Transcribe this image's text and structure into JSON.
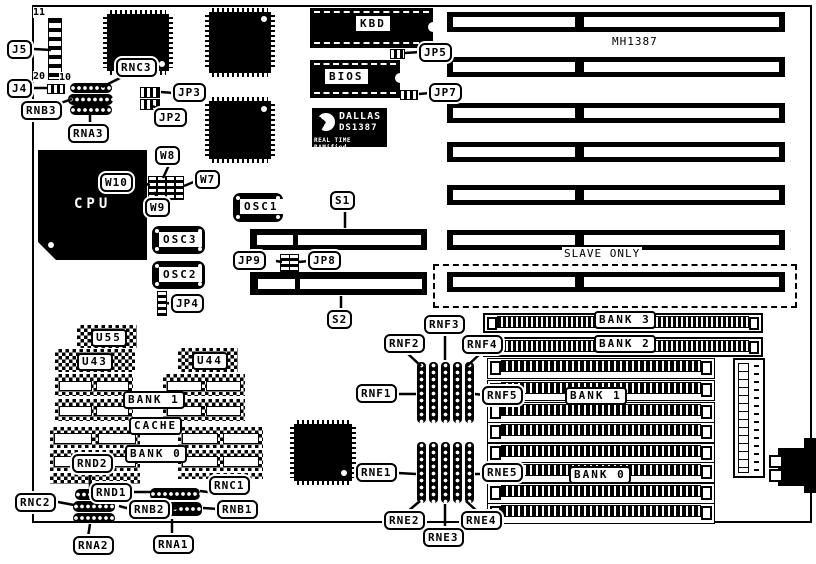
{
  "board": {
    "model": "MH1387",
    "slave_only": "SLAVE ONLY"
  },
  "pins": {
    "eleven": "11",
    "twenty": "20",
    "ten": "10"
  },
  "chips": {
    "kbd": "KBD",
    "bios": "BIOS",
    "cpu": "CPU",
    "osc1": "OSC1",
    "osc2": "OSC2",
    "osc3": "OSC3",
    "u55": "U55",
    "u43": "U43",
    "u44": "U44"
  },
  "dallas": {
    "line1": "DALLAS",
    "line2": "DS1387",
    "line3": "REAL TIME RAMified"
  },
  "cache_group": {
    "bank1": "BANK 1",
    "cache": "CACHE",
    "bank0": "BANK 0"
  },
  "memory": {
    "bank3": "BANK 3",
    "bank2": "BANK 2",
    "bank1": "BANK 1",
    "bank0": "BANK 0"
  },
  "callouts": {
    "j5": "J5",
    "j4": "J4",
    "rnb3": "RNB3",
    "rna3": "RNA3",
    "rnc3": "RNC3",
    "jp2": "JP2",
    "jp3": "JP3",
    "jp5": "JP5",
    "jp7": "JP7",
    "w7": "W7",
    "w8": "W8",
    "w9": "W9",
    "w10": "W10",
    "jp4": "JP4",
    "s1": "S1",
    "s2": "S2",
    "jp8": "JP8",
    "jp9": "JP9",
    "rnd1": "RND1",
    "rnd2": "RND2",
    "rnc1": "RNC1",
    "rnc2": "RNC2",
    "rnb1": "RNB1",
    "rnb2": "RNB2",
    "rna1": "RNA1",
    "rna2": "RNA2",
    "rnf1": "RNF1",
    "rnf2": "RNF2",
    "rnf3": "RNF3",
    "rnf4": "RNF4",
    "rnf5": "RNF5",
    "rne1": "RNE1",
    "rne2": "RNE2",
    "rne3": "RNE3",
    "rne4": "RNE4",
    "rne5": "RNE5"
  },
  "colors": {
    "ink": "#000000",
    "paper": "#ffffff"
  }
}
